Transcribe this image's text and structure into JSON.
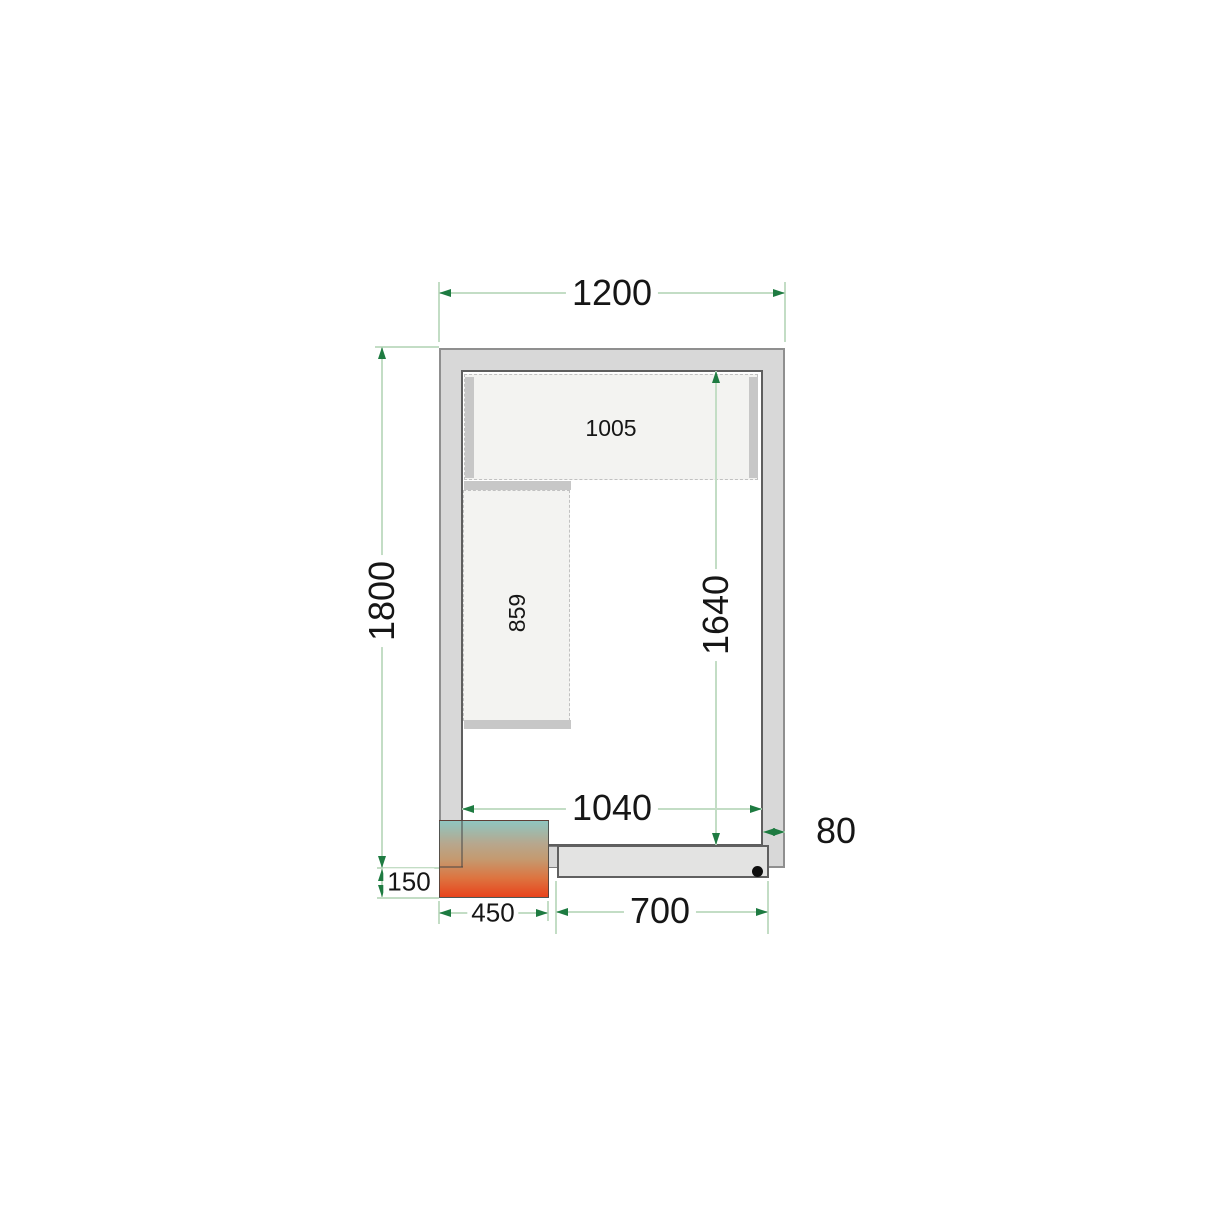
{
  "diagram": {
    "type": "cold-room-floor-plan",
    "labels": {
      "outer_width": "1200",
      "outer_depth": "1800",
      "inner_depth": "1640",
      "inner_width": "1040",
      "wall_thickness": "80",
      "unit_overhang": "150",
      "unit_width": "450",
      "door_width": "700",
      "top_shelf_length": "1005",
      "left_shelf_length": "859"
    },
    "colors": {
      "dimension_line": "#c3ddc5",
      "arrowhead": "#1e7b41",
      "wall_fill": "#d8d8d8",
      "door_leaf_fill": "#e3e3e2",
      "shelf_fill": "#f3f3f1",
      "shelf_bracket": "#c7c7c7",
      "unit_gradient_top": "#8fc6c0",
      "unit_gradient_middle": "#c49a70",
      "unit_gradient_bottom": "#e8431c",
      "hinge_dot": "#0e0e0e",
      "text": "#161616"
    }
  }
}
